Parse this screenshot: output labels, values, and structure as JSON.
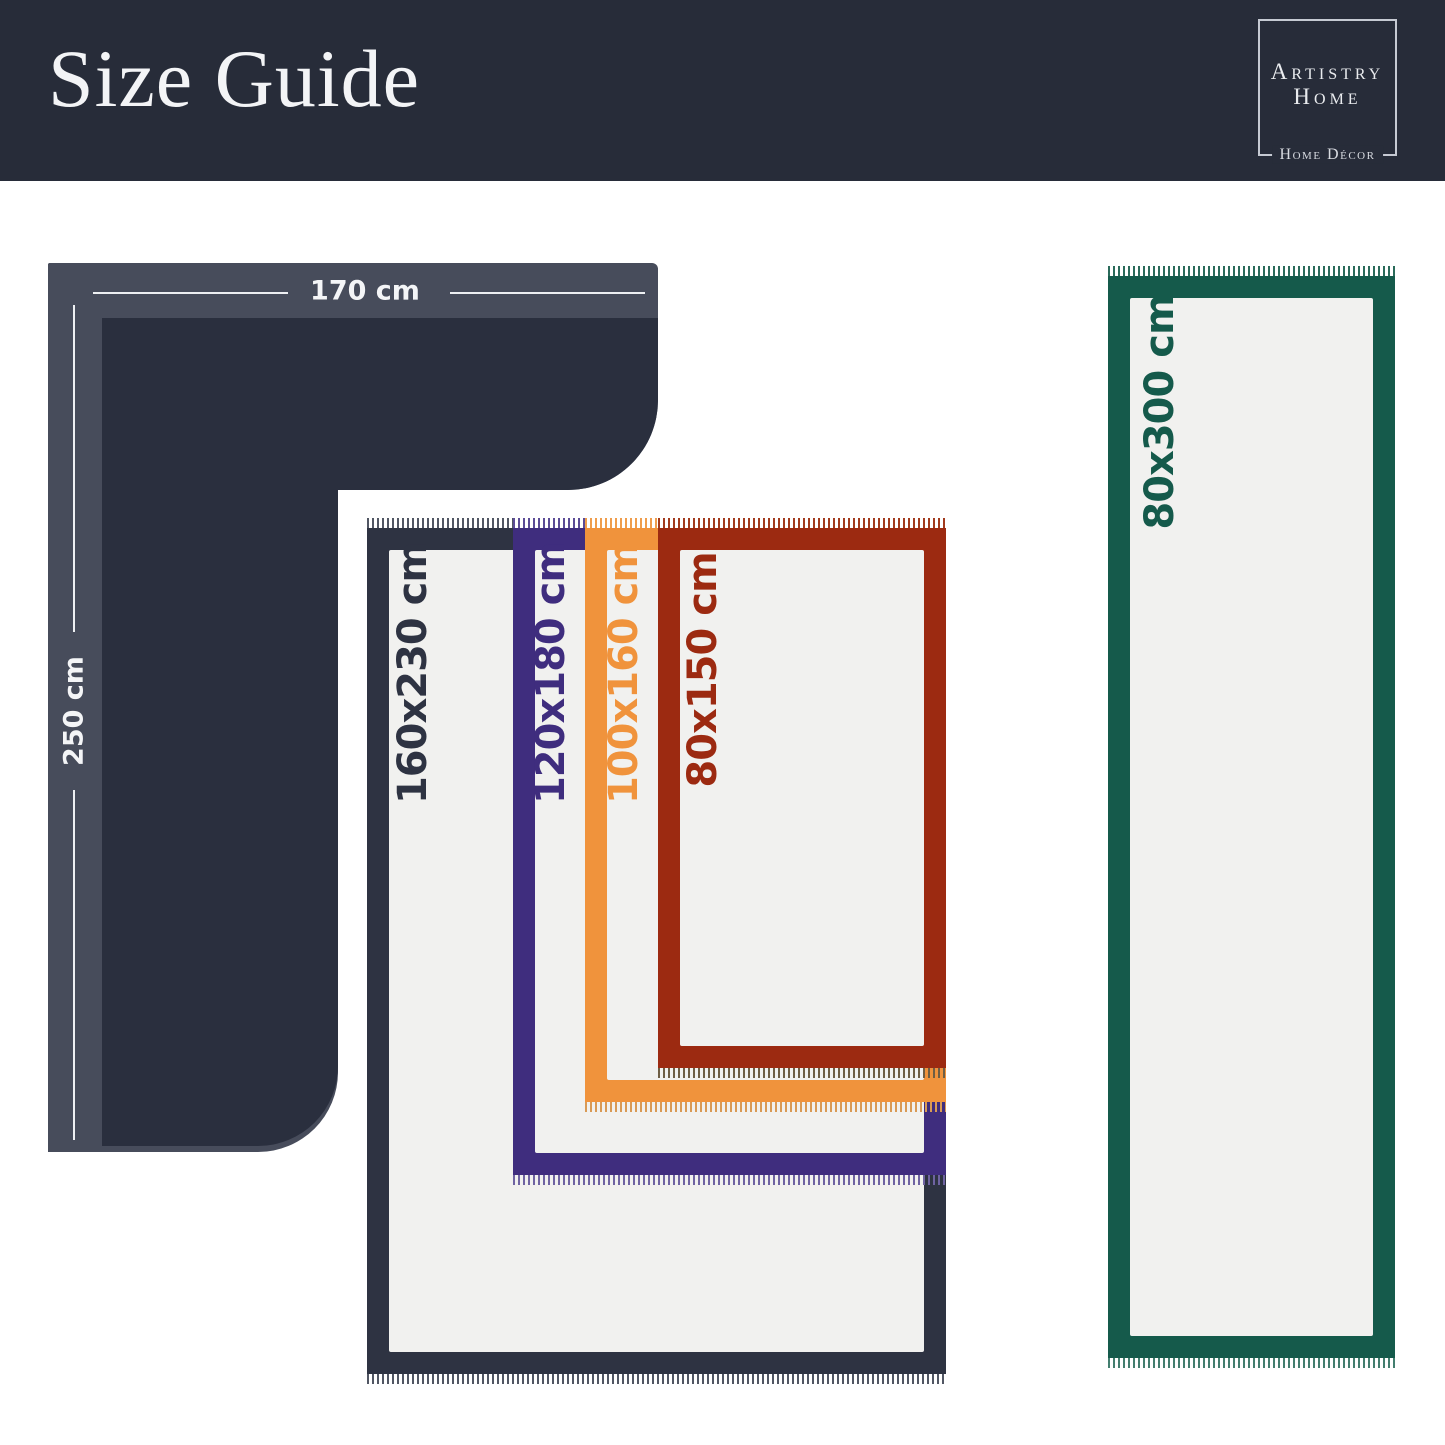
{
  "header": {
    "title": "Size Guide",
    "logo": {
      "name_line1": "Artistry",
      "name_line2": "Home",
      "tagline": "Home Décor"
    }
  },
  "corner_rug": {
    "width_label": "170 cm",
    "height_label": "250 cm",
    "outer_color": "#474c5b",
    "inner_color": "#2a2f3e"
  },
  "rugs": [
    {
      "id": "rug-160x230",
      "label": "160x230 cm",
      "color": "#2e3342"
    },
    {
      "id": "rug-120x180",
      "label": "120x180 cm",
      "color": "#3f2d7e"
    },
    {
      "id": "rug-100x160",
      "label": "100x160 cm",
      "color": "#f0933c"
    },
    {
      "id": "rug-80x150",
      "label": "80x150 cm",
      "color": "#9c2a11"
    },
    {
      "id": "runner-80x300",
      "label": "80x300 cm",
      "color": "#155a4b"
    }
  ],
  "colors": {
    "page_background": "#ffffff",
    "header_background": "#272c39",
    "rug_interior": "#f1f1ef"
  }
}
